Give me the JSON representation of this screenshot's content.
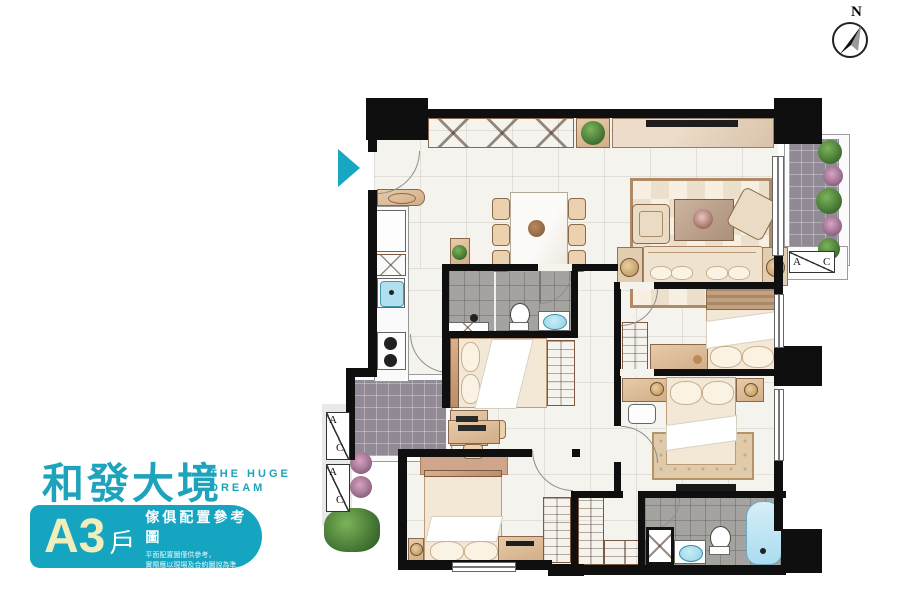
{
  "brand": {
    "logo_text": "和發大境",
    "logo_sub_line1": "THE HUGE",
    "logo_sub_line2": "DREAM",
    "accent_color": "#1da3bb"
  },
  "badge": {
    "unit": "A3",
    "unit_suffix": "戶",
    "title": "傢俱配置參考圖",
    "disclaimer_line1": "平面配置圖僅供參考，",
    "disclaimer_line2": "實際應以現場及合約圖說為準",
    "background_color": "#16a5c0",
    "unit_color": "#f1eebc"
  },
  "compass": {
    "north_label": "N"
  },
  "ac_units": {
    "a_label": "A",
    "c_label": "C"
  },
  "palette": {
    "wall": "#0f0f0f",
    "floor": "#f5f3ee",
    "balcony_tile": "#918a95",
    "bath_tile": "#a5a3a0",
    "wood": "#c49a76",
    "water_fixture": "#8fd3e6",
    "entrance_arrow": "#18a7c2"
  }
}
